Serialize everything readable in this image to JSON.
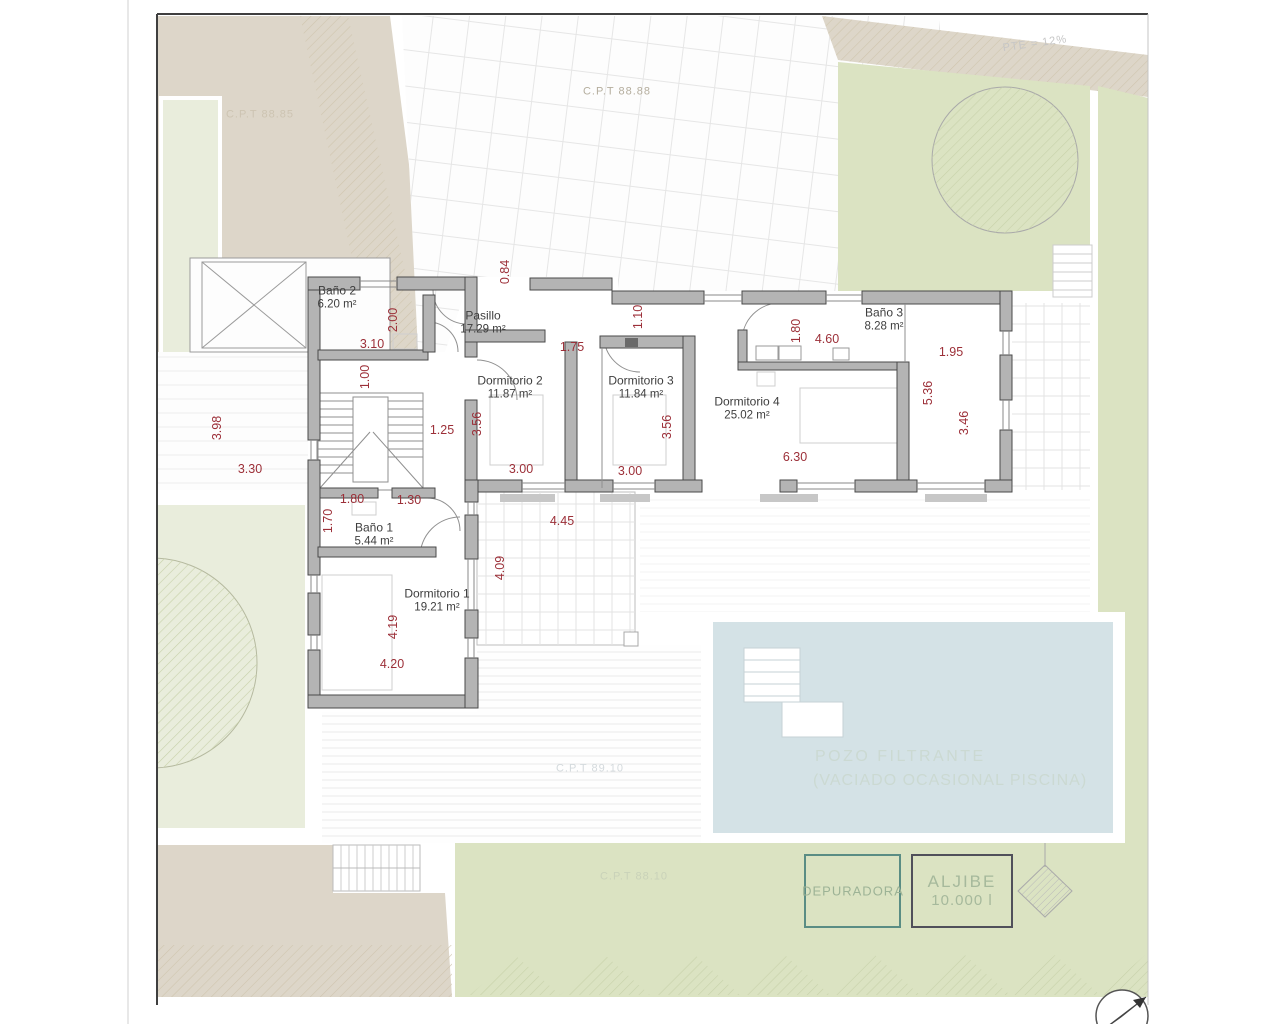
{
  "plan": {
    "rooms": [
      {
        "name": "Baño 2",
        "area": "6.20 m²",
        "x": 337,
        "y": 298
      },
      {
        "name": "Pasillo",
        "area": "17.29 m²",
        "x": 483,
        "y": 323
      },
      {
        "name": "Dormitorio 2",
        "area": "11.87 m²",
        "x": 510,
        "y": 388
      },
      {
        "name": "Dormitorio 3",
        "area": "11.84 m²",
        "x": 641,
        "y": 388
      },
      {
        "name": "Dormitorio 4",
        "area": "25.02 m²",
        "x": 747,
        "y": 409
      },
      {
        "name": "Baño 3",
        "area": "8.28 m²",
        "x": 884,
        "y": 320
      },
      {
        "name": "Baño 1",
        "area": "5.44 m²",
        "x": 374,
        "y": 535
      },
      {
        "name": "Dormitorio 1",
        "area": "19.21 m²",
        "x": 437,
        "y": 601
      }
    ],
    "dimensions": [
      {
        "value": "0.84",
        "x": 505,
        "y": 272,
        "rot": true
      },
      {
        "value": "3.10",
        "x": 372,
        "y": 344
      },
      {
        "value": "2.00",
        "x": 393,
        "y": 320,
        "rot": true
      },
      {
        "value": "1.00",
        "x": 365,
        "y": 377,
        "rot": true
      },
      {
        "value": "3.98",
        "x": 217,
        "y": 428,
        "rot": true
      },
      {
        "value": "3.30",
        "x": 250,
        "y": 469
      },
      {
        "value": "1.25",
        "x": 442,
        "y": 430
      },
      {
        "value": "3.56",
        "x": 477,
        "y": 424,
        "rot": true
      },
      {
        "value": "3.00",
        "x": 521,
        "y": 469
      },
      {
        "value": "1.75",
        "x": 572,
        "y": 347
      },
      {
        "value": "1.10",
        "x": 638,
        "y": 317,
        "rot": true
      },
      {
        "value": "3.56",
        "x": 667,
        "y": 427,
        "rot": true
      },
      {
        "value": "3.00",
        "x": 630,
        "y": 471
      },
      {
        "value": "1.80",
        "x": 796,
        "y": 331,
        "rot": true
      },
      {
        "value": "4.60",
        "x": 827,
        "y": 339
      },
      {
        "value": "1.95",
        "x": 951,
        "y": 352
      },
      {
        "value": "5.36",
        "x": 928,
        "y": 393,
        "rot": true
      },
      {
        "value": "3.46",
        "x": 964,
        "y": 423,
        "rot": true
      },
      {
        "value": "6.30",
        "x": 795,
        "y": 457
      },
      {
        "value": "1.80",
        "x": 352,
        "y": 499
      },
      {
        "value": "1.30",
        "x": 409,
        "y": 500
      },
      {
        "value": "1.70",
        "x": 328,
        "y": 521,
        "rot": true
      },
      {
        "value": "4.45",
        "x": 562,
        "y": 521
      },
      {
        "value": "4.09",
        "x": 500,
        "y": 568,
        "rot": true
      },
      {
        "value": "4.19",
        "x": 393,
        "y": 627,
        "rot": true
      },
      {
        "value": "4.20",
        "x": 392,
        "y": 664
      }
    ],
    "site_labels": [
      {
        "text": "C.P.T 88.88",
        "x": 617,
        "y": 92,
        "cls": "faint-tan"
      },
      {
        "text": "PTE = 12%",
        "x": 1035,
        "y": 44,
        "cls": "faint-grey"
      },
      {
        "text": "C.P.T 88.85",
        "x": 260,
        "y": 115,
        "cls": "faint-tan2"
      },
      {
        "text": "C.P.T 89.10",
        "x": 590,
        "y": 769,
        "cls": "faint-blue"
      },
      {
        "text": "C.P.T 88.10",
        "x": 634,
        "y": 877,
        "cls": "faint-green"
      }
    ],
    "pool": {
      "line1": "POZO FILTRANTE",
      "line2": "(VACIADO OCASIONAL PISCINA)"
    },
    "equipment": {
      "depuradora": "DEPURADORA",
      "aljibe_name": "ALJIBE",
      "aljibe_capacity": "10.000 l"
    },
    "colors": {
      "beige": "#ddd6c9",
      "pale_green": "#e9eddc",
      "green": "#dbe3c2",
      "pool_blue": "#d4e2e6",
      "wall_grey": "#b4b4b4",
      "dim_red": "#9c2f38",
      "depuradora_border": "#5a8d84",
      "aljibe_border": "#50505a"
    }
  }
}
